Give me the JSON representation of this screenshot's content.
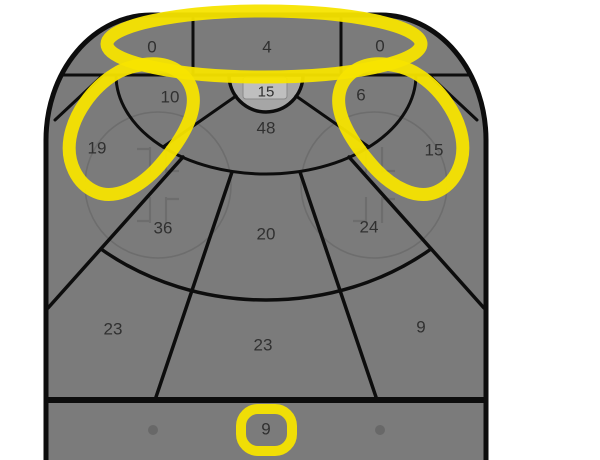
{
  "chart_data": {
    "type": "heatmap",
    "description": "Hockey offensive-zone shot chart divided into zones with shot counts; several zones are circled with a yellow marker highlight",
    "orientation": "goal-at-top",
    "zones": [
      {
        "name": "behind-goal-left",
        "value": 0,
        "highlighted": true
      },
      {
        "name": "behind-goal-center",
        "value": 4,
        "highlighted": true
      },
      {
        "name": "behind-goal-right",
        "value": 0,
        "highlighted": true
      },
      {
        "name": "crease",
        "value": 15,
        "highlighted": false
      },
      {
        "name": "inner-left",
        "value": 10,
        "highlighted": true
      },
      {
        "name": "slot",
        "value": 48,
        "highlighted": false
      },
      {
        "name": "inner-right",
        "value": 6,
        "highlighted": true
      },
      {
        "name": "left-faceoff",
        "value": 19,
        "highlighted": true
      },
      {
        "name": "right-faceoff",
        "value": 15,
        "highlighted": true
      },
      {
        "name": "mid-left",
        "value": 36,
        "highlighted": false
      },
      {
        "name": "mid-center",
        "value": 20,
        "highlighted": false
      },
      {
        "name": "mid-right",
        "value": 24,
        "highlighted": false
      },
      {
        "name": "outer-left",
        "value": 23,
        "highlighted": false
      },
      {
        "name": "outer-center",
        "value": 23,
        "highlighted": false
      },
      {
        "name": "outer-right",
        "value": 9,
        "highlighted": false
      },
      {
        "name": "beyond-blue-line",
        "value": 9,
        "highlighted": true
      }
    ],
    "legend_position": "none",
    "grid": false
  },
  "colors": {
    "rink_fill": "#7b7b7b",
    "crease_fill": "#a6a6a6",
    "net_fill": "#bfbfbf",
    "line": "#0d0d0d",
    "faint_line": "#6d6d6d",
    "dot": "#686868",
    "highlight": "#f7e400",
    "label_text": "#303030",
    "background": "#ffffff"
  }
}
